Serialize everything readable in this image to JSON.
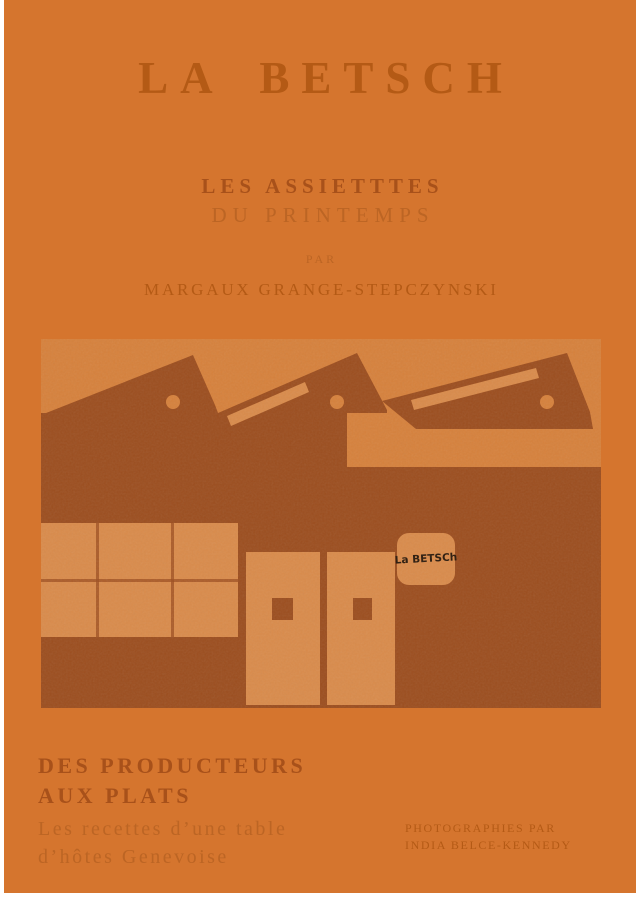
{
  "page": {
    "title": "LA BETSCH",
    "subtitle_line1": "LES ASSIETTTES",
    "subtitle_line2": "DU PRINTEMPS",
    "byline_label": "PAR",
    "author": "MARGAUX GRANGE-STEPCZYNSKI",
    "illustration": {
      "sign_text": "La BETSCh",
      "description": "factory-building-with-sawtooth-roof"
    },
    "footer": {
      "heading_line1": "DES PRODUCTEURS",
      "heading_line2": "AUX PLATS",
      "sub_line1": "Les recettes d’une table",
      "sub_line2": "d’hôtes Genevoise",
      "credit_line1": "PHOTOGRAPHIES PAR",
      "credit_line2": "INDIA BELCE-KENNEDY"
    },
    "colors": {
      "background": "#D5752E",
      "ink_dark": "#A8511A",
      "ink": "#B45A15",
      "ink_light": "#BC6524",
      "illustration_bg": "#D6813C",
      "illustration_light": "#D98B4B",
      "illustration_dark": "#9C4E1F",
      "sign_text": "#2B1A0C",
      "frame": "#FFFFFF"
    }
  }
}
